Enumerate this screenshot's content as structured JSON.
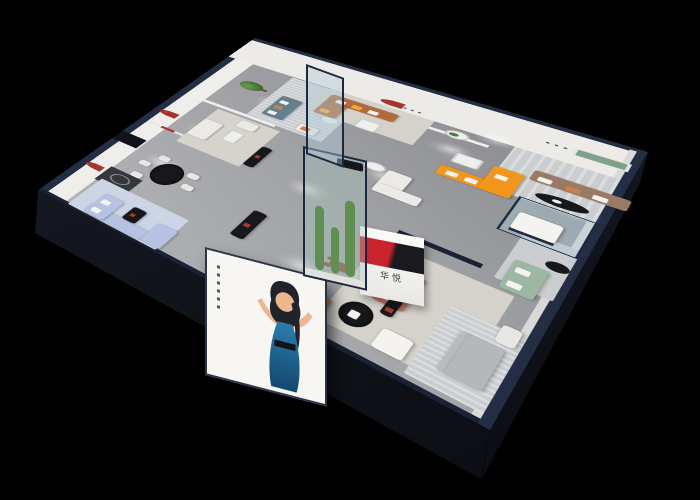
{
  "scene": {
    "description": "3D isometric cutaway rendering of a furniture showroom interior on a black background",
    "background": "#000000"
  },
  "logo": {
    "monogram": "H",
    "brand_name": "华悦",
    "monogram_gradient": "linear-gradient(105deg,#c9242b 46%,#1a1a1e 54%)",
    "panel_gradient": "linear-gradient(180deg,#fbfbf9,#e9e8e4)",
    "caption_color": "#3a3a3c"
  },
  "billboard": {
    "background": "#f7f6f3",
    "frame": "#2a3447",
    "figure": "woman in blue dress with raised arms",
    "dress_top": "#2a7db0",
    "dress_bottom": "#14486e",
    "skin": "#ecb68f",
    "hair": "#20242a"
  },
  "palette": {
    "roof_navy": "#232e45",
    "roof_navy_dark": "#1a2235",
    "wall_face": "#efeeea",
    "wall_face_east": "#edebe7",
    "wall_dark": "#34373c",
    "door_gap": "#10131a",
    "rug_warm": "#d6d3cc",
    "rug_cool": "#cbced1",
    "rug_blue": "#ccd5e6",
    "rug_pale": "#d5d2cb",
    "sofa_white": "#eceae6",
    "sofa_teal": "#64808f",
    "sofa_caramel": "#b06a3c",
    "sofa_orange": "#f2971b",
    "sofa_taupe": "#9b7a64",
    "sofa_sage": "#9cb7a2",
    "sofa_salmon": "#c4756a",
    "sofa_periwinkle": "#b6c2e2",
    "sofa_gray": "#b5b7ba",
    "pillow_white": "#f4f3f0",
    "pillow_orange": "#cd7f4e",
    "pillow_yellow": "#efab28",
    "table_black": "#17181b",
    "table_white": "#eef0ef",
    "wood_orange": "#cf7f3f",
    "accent_red": "#b0372e",
    "arch_red": "#a8352c",
    "niche_green": "#7fa18c",
    "plant_green": "#4e7b3e",
    "trunk_brown": "#6b4a32",
    "cactus_green": "#5f8f51",
    "bear_brown": "#8a4b39",
    "glass_tint": "rgba(176,203,214,0.42)",
    "glass_tint_green": "rgba(168,196,186,0.4)",
    "sculpture_dark": "#2a2a2c",
    "ring_light": "#e9e6de",
    "chair_white": "#e8e7e3"
  }
}
